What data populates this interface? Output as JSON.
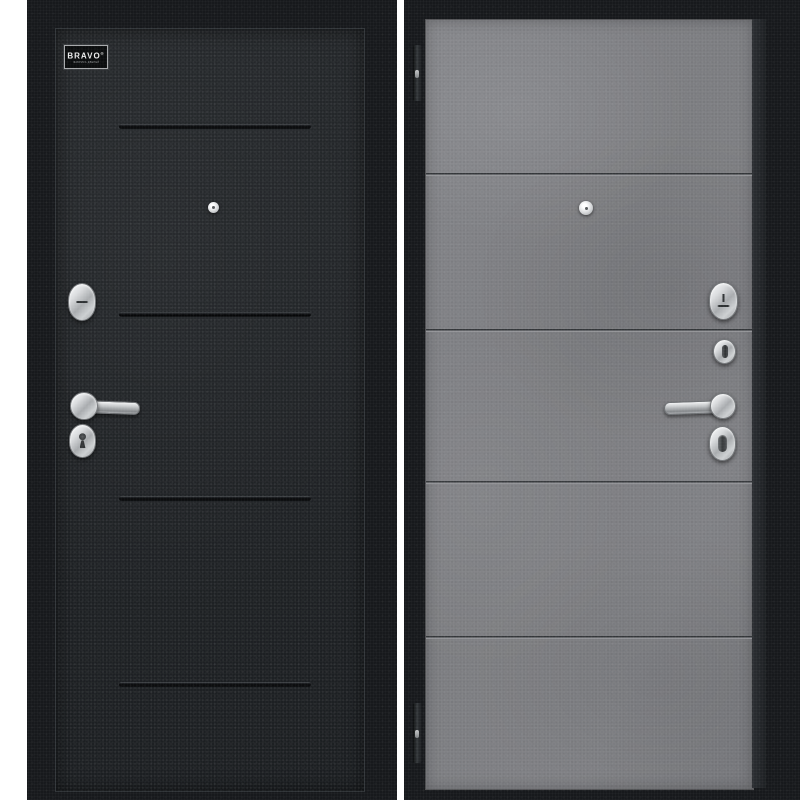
{
  "brand": {
    "label": "BRAVO",
    "registered_mark": "®",
    "subtext": "ФАБРИКА ДВЕРЕЙ"
  },
  "image": {
    "subject": "steel entry door shown from both sides, front black panel and back concrete-grey panel",
    "background_color": "#ffffff"
  },
  "colors": {
    "frame_black": "#17191c",
    "left_leaf_black": "#202326",
    "right_leaf_concrete": "#818285",
    "hardware_chrome": "#cfd2d4",
    "groove_dark": "#0a0c0d"
  },
  "left_panel": {
    "groove_count": 4,
    "hardware": [
      "peephole",
      "thumbturn-escutcheon",
      "lever-handle",
      "keyhole-escutcheon"
    ],
    "logo_plate": true
  },
  "right_panel": {
    "groove_count": 4,
    "hinge_count": 2,
    "hardware": [
      "peephole",
      "thumbturn-escutcheon",
      "cylinder-lock",
      "lever-handle",
      "night-latch-knob"
    ]
  }
}
